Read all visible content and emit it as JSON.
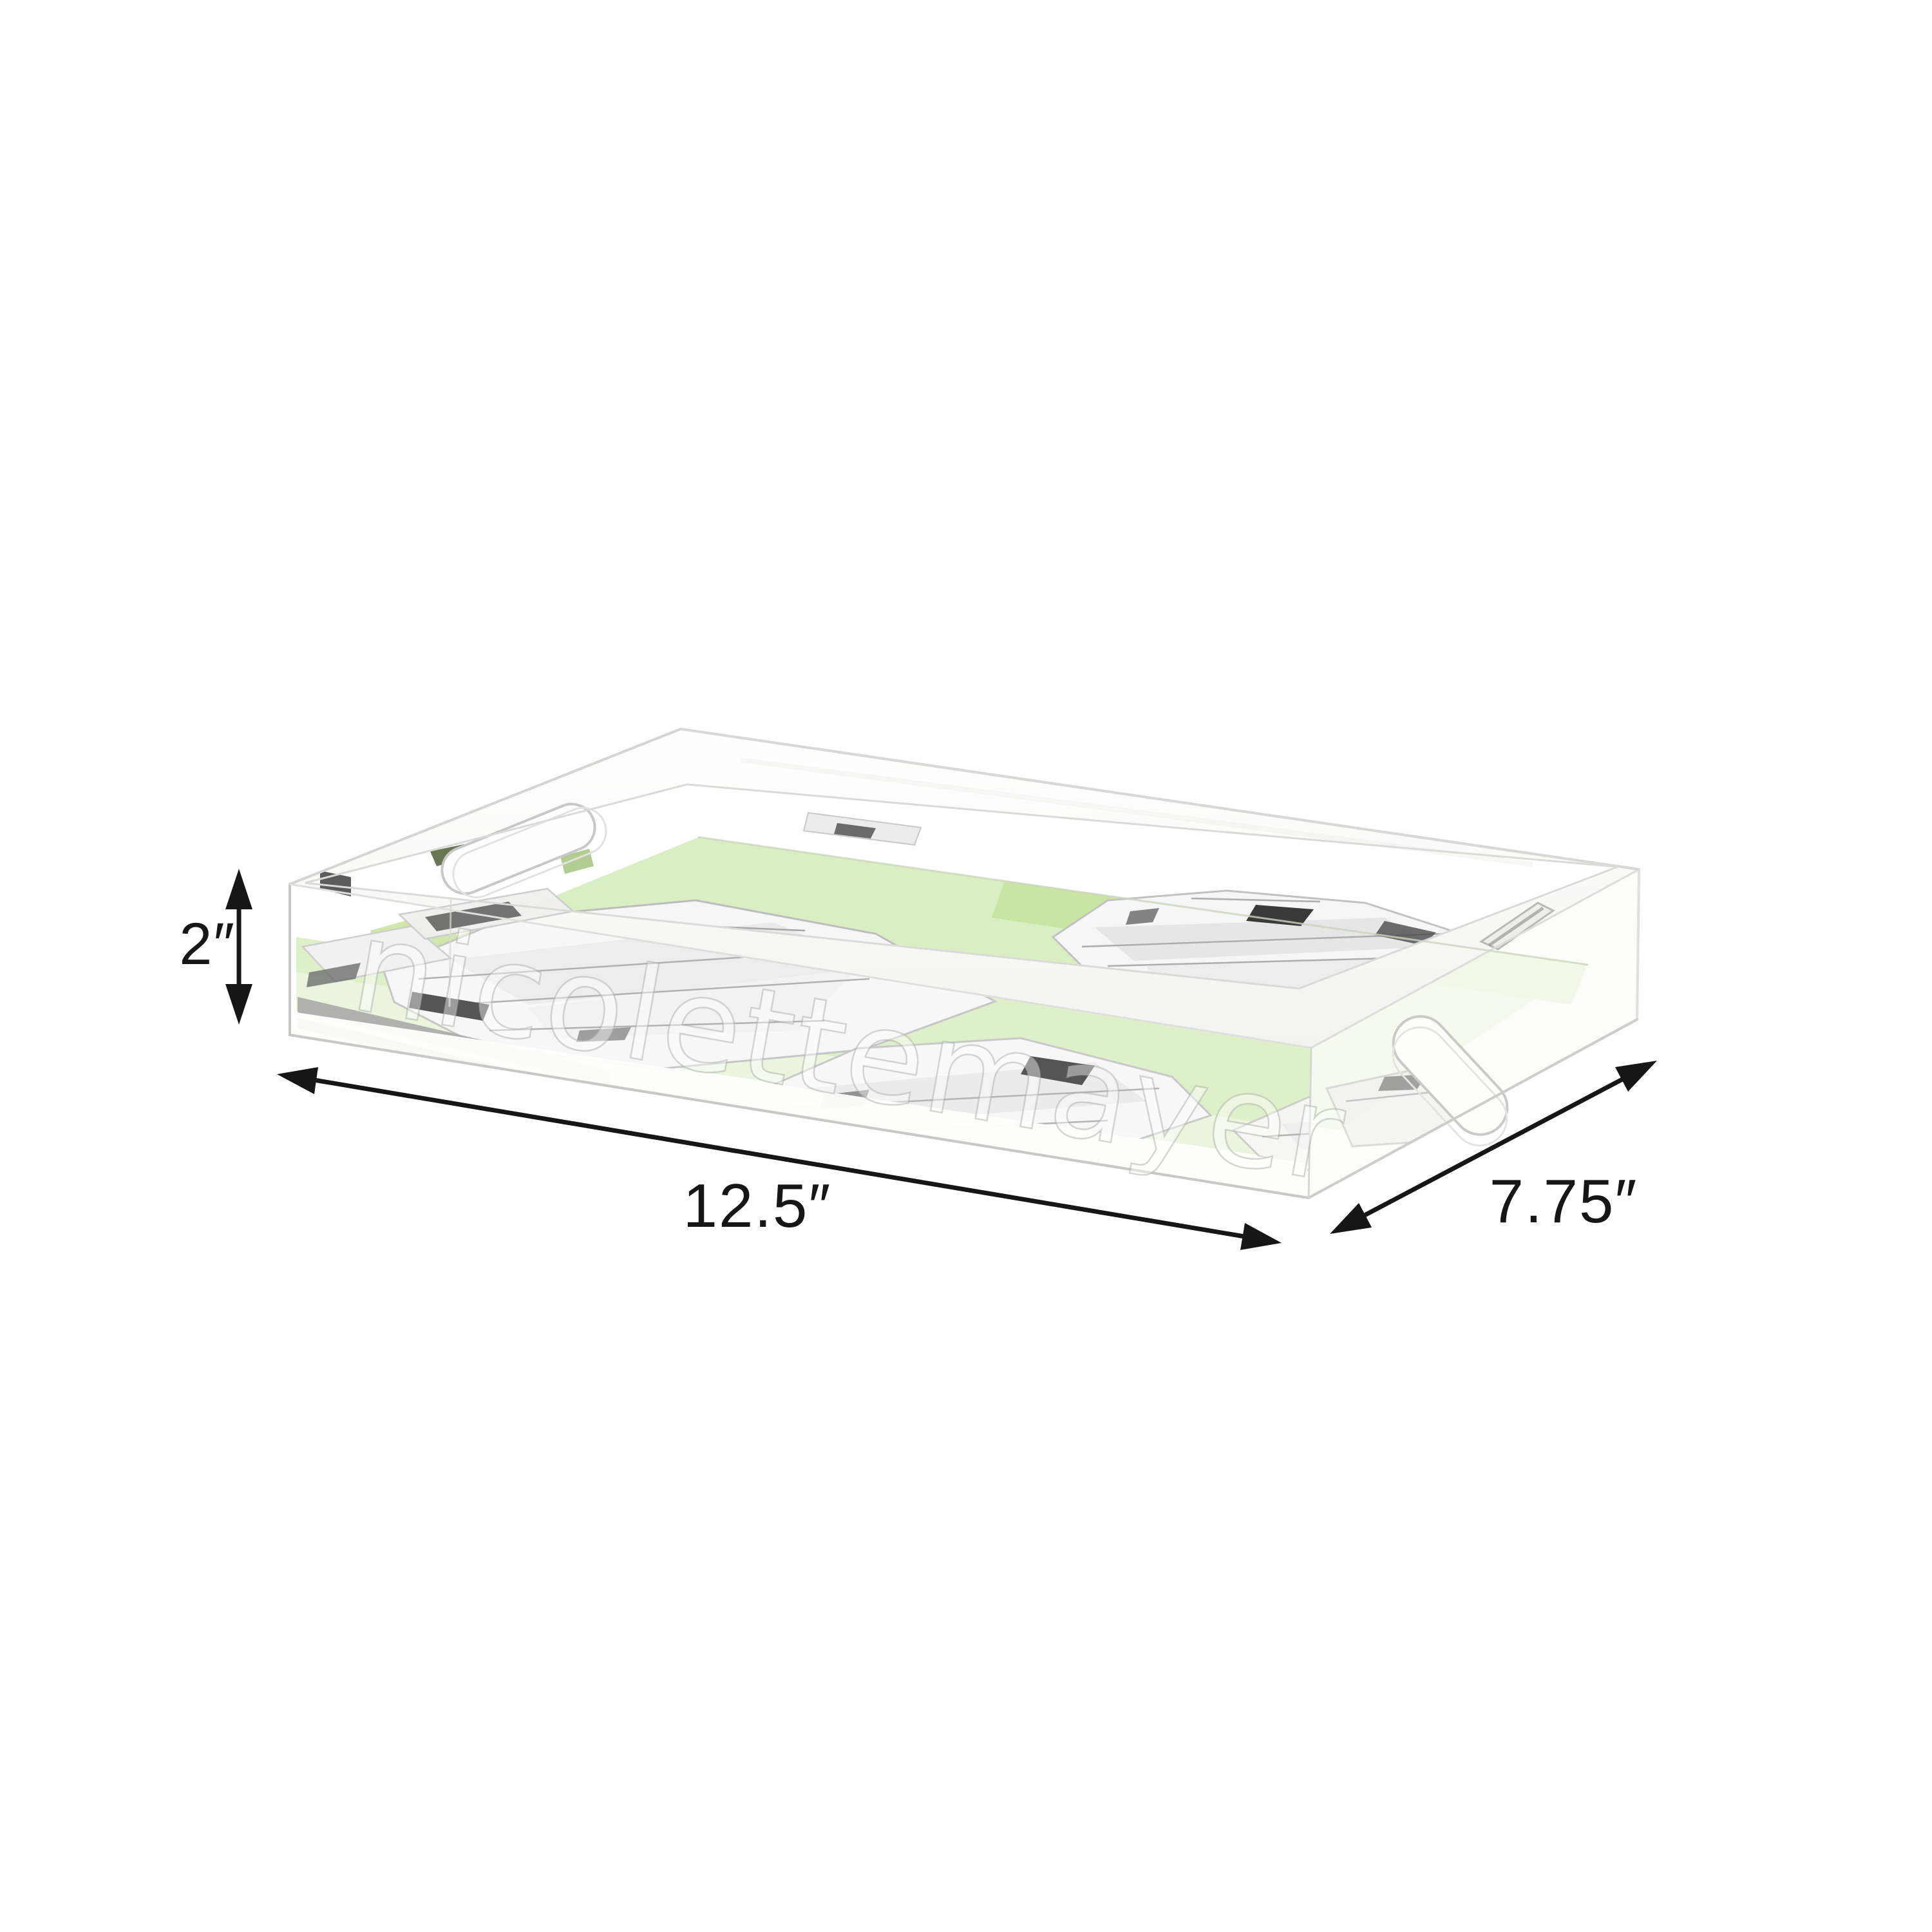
{
  "diagram": {
    "watermark": "nicolettemayer",
    "dimension_labels": {
      "height": "2″",
      "length": "12.5″",
      "depth": "7.75″"
    },
    "colors": {
      "background": "#ffffff",
      "annotation": "#161616",
      "floor_green": "#d9eec2",
      "floor_green_bright": "#c7e39d",
      "floor_green_pale": "#e9f4db",
      "crystal_light": "#f6f6f6",
      "crystal_mid": "#e6e6e6",
      "crystal_dark": "#3a3a3a",
      "edge": "#d2d2d0"
    }
  }
}
